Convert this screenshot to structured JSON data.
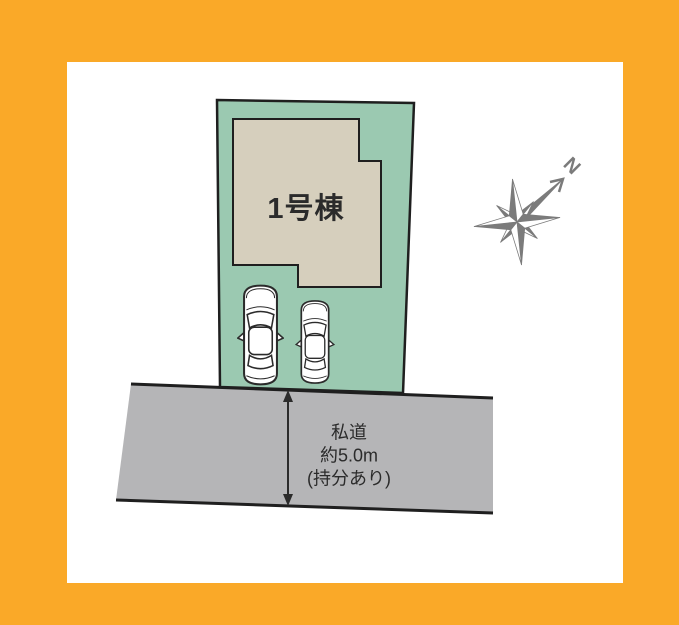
{
  "diagram": {
    "house": {
      "label": "1号棟"
    },
    "road": {
      "label_lines": [
        "私道",
        "約5.0m",
        "(持分あり)"
      ]
    },
    "compass": {
      "north_label": "N"
    },
    "colors": {
      "frame_orange": "#FAA928",
      "panel_white": "#FFFFFF",
      "plot_green": "#9BC9B1",
      "house_beige": "#D6CFBD",
      "road_gray": "#B5B5B7",
      "outline_dark": "#1F1F1F",
      "compass_gray": "#7B7B7B",
      "text_dark": "#2B2B2B"
    }
  }
}
